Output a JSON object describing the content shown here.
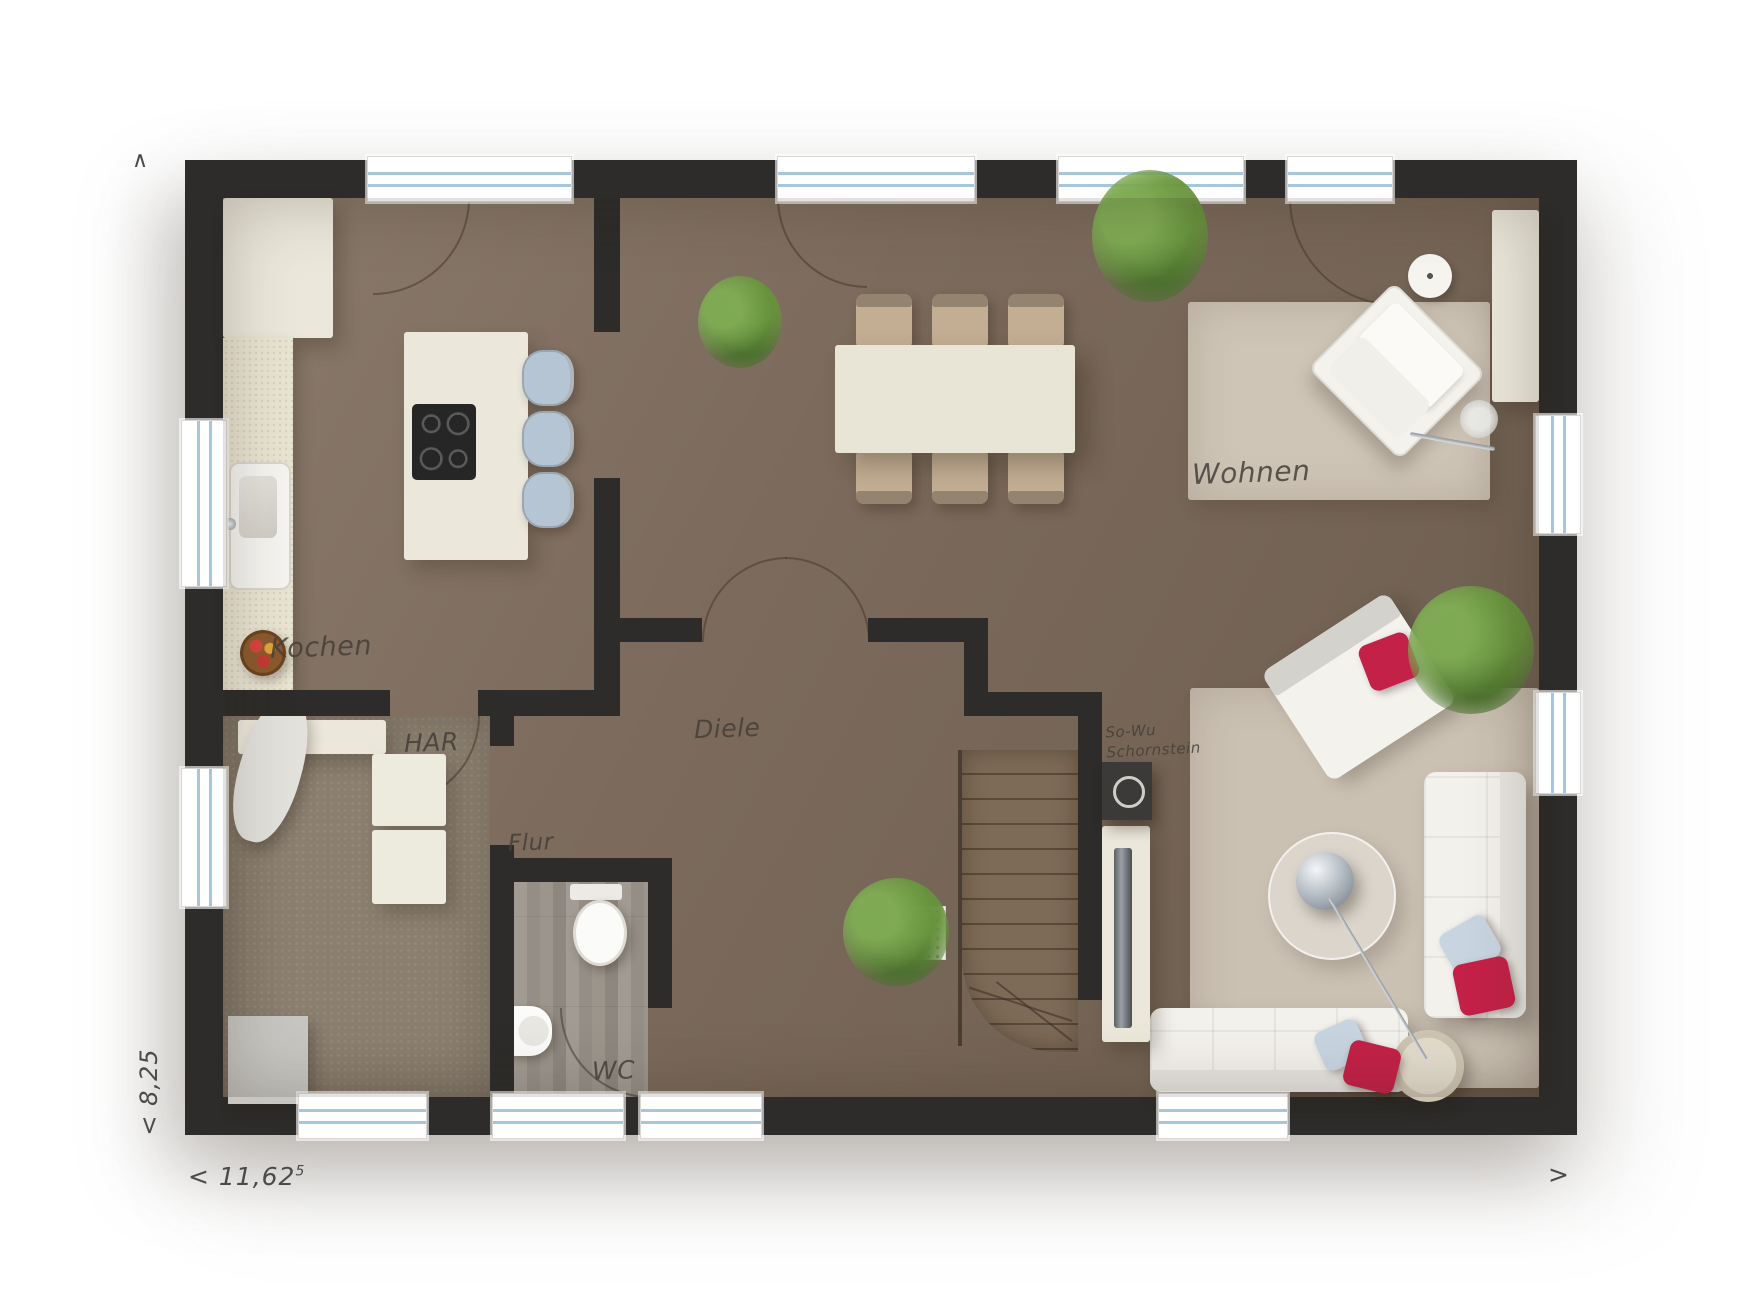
{
  "rooms": {
    "kochen": {
      "label": "Kochen"
    },
    "har": {
      "label": "HAR"
    },
    "flur": {
      "label": "Flur"
    },
    "diele": {
      "label": "Diele"
    },
    "wc": {
      "label": "WC"
    },
    "wohnen": {
      "label": "Wohnen"
    },
    "chimney": {
      "line1": "So-Wu",
      "line2": "Schornstein"
    }
  },
  "dimensions": {
    "width_value": "< 11,62",
    "width_superscript": "5",
    "depth_value": "< 8,25",
    "arrow_top_left": "∧",
    "arrow_bottom_right": ">"
  },
  "colors": {
    "wall": "#2d2c2a",
    "wood_floor": "#7c6b5c",
    "carpet": "#8b7f70",
    "rug": "#cfc5b7",
    "cream": "#ebe8db",
    "pillow_red": "#c32148",
    "pillow_blue": "#c8d5e1",
    "stool": "#b5c5d3",
    "glass": "#a6c6dc",
    "plant_green": "#68923f",
    "stair_wood": "#7d6a56"
  }
}
